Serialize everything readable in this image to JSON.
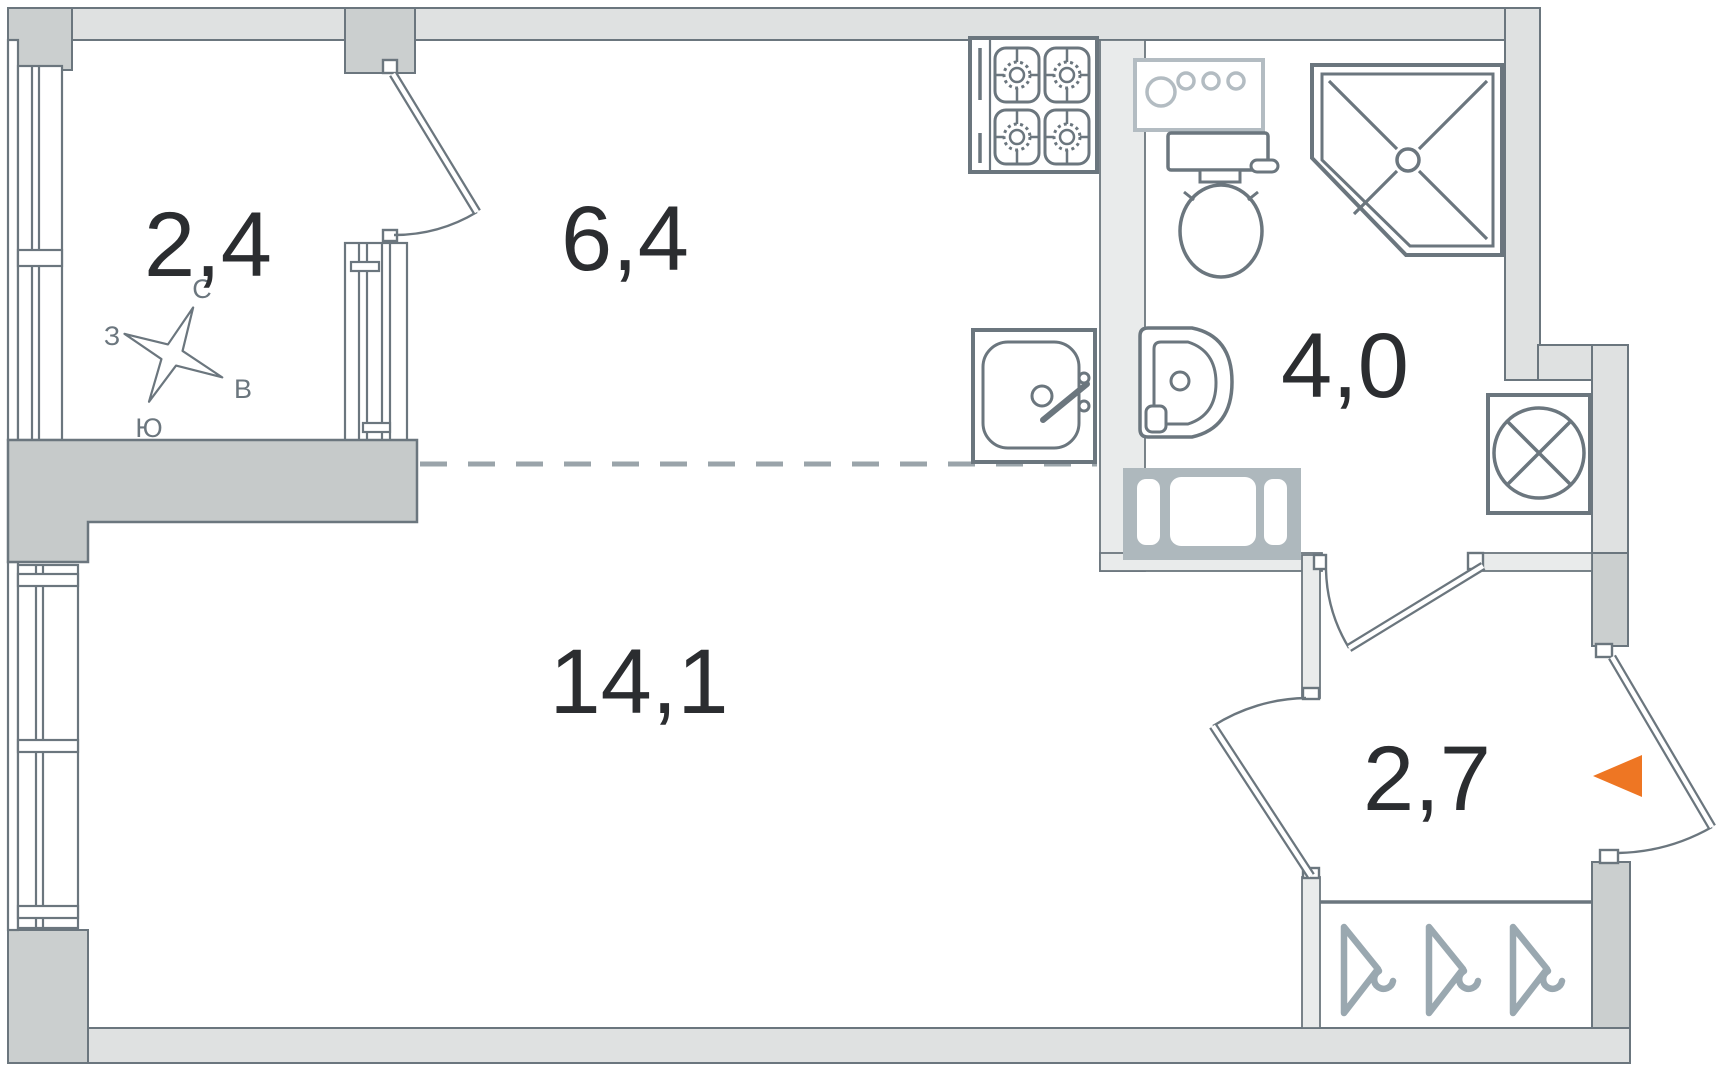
{
  "plan": {
    "rooms": [
      {
        "name": "balcony",
        "area": "2,4"
      },
      {
        "name": "kitchen",
        "area": "6,4"
      },
      {
        "name": "bathroom",
        "area": "4,0"
      },
      {
        "name": "living-room",
        "area": "14,1"
      },
      {
        "name": "hallway",
        "area": "2,7"
      }
    ],
    "compass": {
      "north": "С",
      "west": "З",
      "east": "В",
      "south": "Ю"
    },
    "icons": [
      "compass-rose-icon",
      "stove-icon",
      "kitchen-sink-icon",
      "laundry-counter-icon",
      "toilet-icon",
      "washbasin-icon",
      "shower-icon",
      "washing-machine-icon",
      "coat-hanger-icon",
      "vent-shaft-icon",
      "entrance-arrow-icon"
    ],
    "colors": {
      "wall_light": "#dfe1e1",
      "wall_medium": "#cbcfcf",
      "wall_dark": "#c6caca",
      "partition": "#e9ebeb",
      "vent": "#aeb8bd",
      "line": "#6b767e",
      "line_light": "#b3bcc2",
      "hanger": "#9aa8b0",
      "dash": "#9aa4aa",
      "text": "#2b2d30",
      "accent_orange": "#ee7623"
    }
  }
}
